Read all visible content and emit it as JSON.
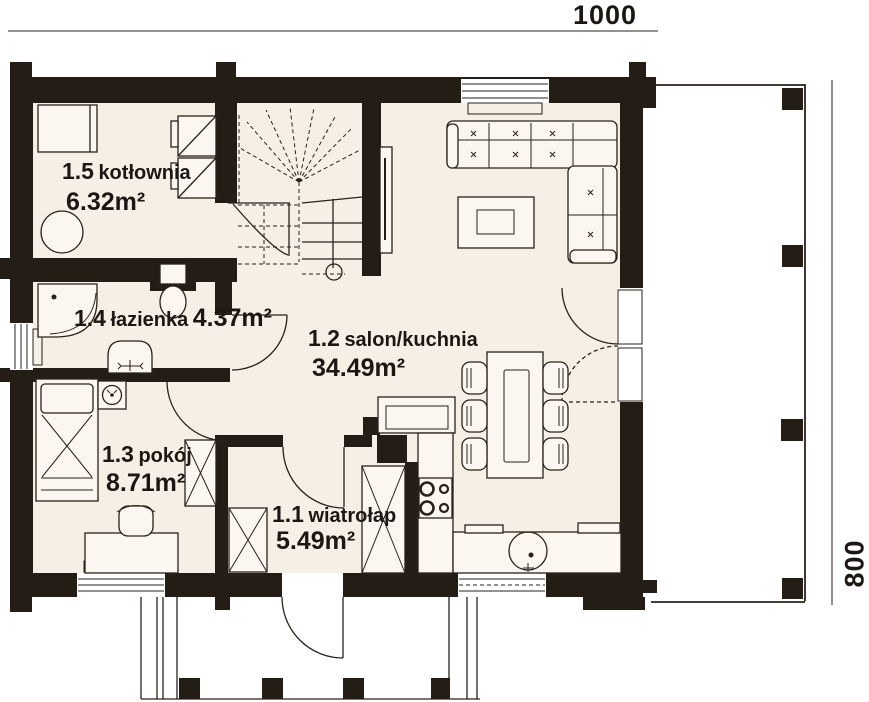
{
  "title": "Rzut parteru – plan domu",
  "dimensions": {
    "width": "1000",
    "depth": "800"
  },
  "rooms": [
    {
      "code": "1.5",
      "name": "kotłownia",
      "area": "6.32m²"
    },
    {
      "code": "1.4",
      "name": "łazienka",
      "area": "4.37m²"
    },
    {
      "code": "1.2",
      "name": "salon/kuchnia",
      "area": "34.49m²"
    },
    {
      "code": "1.3",
      "name": "pokój",
      "area": "8.71m²"
    },
    {
      "code": "1.1",
      "name": "wiatrołap",
      "area": "5.49m²"
    }
  ],
  "colors": {
    "wall": "#231d16",
    "floor": "#f6efe5",
    "line": "#29221b",
    "text": "#1c1712",
    "background": "#ffffff"
  }
}
